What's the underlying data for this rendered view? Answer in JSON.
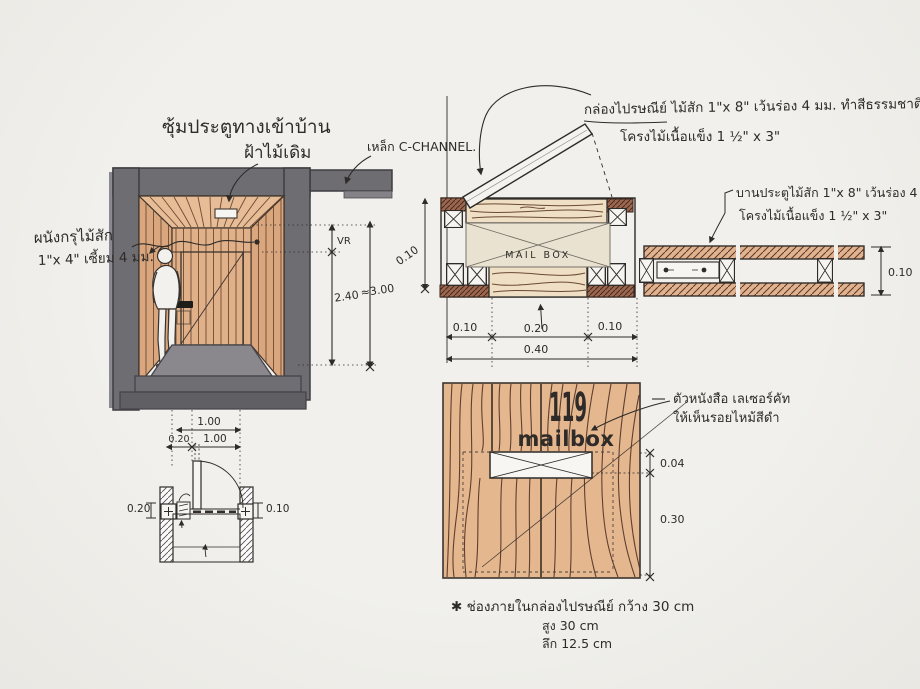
{
  "labels": {
    "title": "ซุ้มประตูทางเข้าบ้าน",
    "ceiling": "ฝ้าไม้เดิม",
    "c_channel": "เหล็ก C-CHANNEL.",
    "wall_line1": "ผนังกรุไม้สัก",
    "wall_line2": "1\"x 4\" เซี้ยม 4 มม.",
    "mailbox_spec1": "กล่องไปรษณีย์ ไม้สัก 1\"x 8\" เว้นร่อง 4 มม. ทำสีธรรมชาติ",
    "mailbox_spec2": "โครงไม้เนื้อแข็ง 1 ½\" x 3\"",
    "door_spec1": "บานประตูไม้สัก 1\"x 8\" เว้นร่อง 4 มม. ทำสีธรรมชาติ",
    "door_spec2": "โครงไม้เนื้อแข็ง 1 ½\" x 3\"",
    "laser1": "ตัวหนังสือ เลเซอร์คัท",
    "laser2": "ให้เห็นรอยไหม้สีดำ",
    "plan_mailbox": "MAIL BOX",
    "house_number": "119",
    "mailbox_word": "mailbox"
  },
  "dims": {
    "vr": "VR",
    "door_height": "2.40",
    "total_height": "≈3.00",
    "opening_width_top": "1.00",
    "wall_left": "0.20",
    "opening_width": "1.00",
    "plan_left_wall": "0.20",
    "plan_right_wall": "0.10",
    "box_depth": "0.10",
    "box_seg_left": "0.10",
    "box_seg_mid": "0.20",
    "box_seg_right": "0.10",
    "box_total": "0.40",
    "wall_thickness": "0.10",
    "slot_height": "0.04",
    "slot_offset": "0.30"
  },
  "note": {
    "line1": "✱ ช่องภายในกล่องไปรษณีย์   กว้าง 30 cm",
    "line2": "สูง  30 cm",
    "line3": "ลึก  12.5 cm"
  },
  "colors": {
    "paper": "#f0efeb",
    "ink": "#2e2b28",
    "frame_gray": "#6e6d71",
    "wood_tan": "#d9a67e",
    "wood_pale": "#eedfc5",
    "wood_salmon": "#e2b28e",
    "wood_front": "#e5b78f",
    "grain_brown": "#57392a",
    "mailbox_beige": "#e9e2d0"
  }
}
